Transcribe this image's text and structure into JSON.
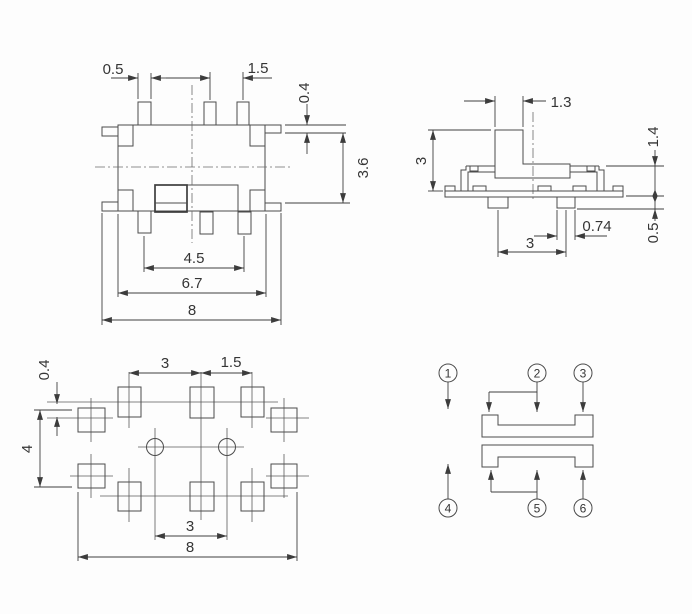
{
  "top_view": {
    "dims": {
      "pin_width": "0.5",
      "pin_pitch": "1.5",
      "tab_height": "0.4",
      "body_height": "3.6",
      "pin_span": "4.5",
      "body_width": "6.7",
      "overall_width": "8"
    }
  },
  "side_view": {
    "dims": {
      "knob_width": "1.3",
      "height": "3",
      "upper_height": "1.4",
      "foot_width": "0.74",
      "foot_height": "0.5",
      "foot_pitch": "3"
    }
  },
  "footprint_view": {
    "dims": {
      "pad_offset": "0.4",
      "pad_span": "4",
      "pitch_left": "3",
      "pitch_right": "1.5",
      "hole_pitch": "3",
      "overall_width": "8"
    }
  },
  "schematic": {
    "pin_labels": [
      "1",
      "2",
      "3",
      "4",
      "5",
      "6"
    ]
  }
}
